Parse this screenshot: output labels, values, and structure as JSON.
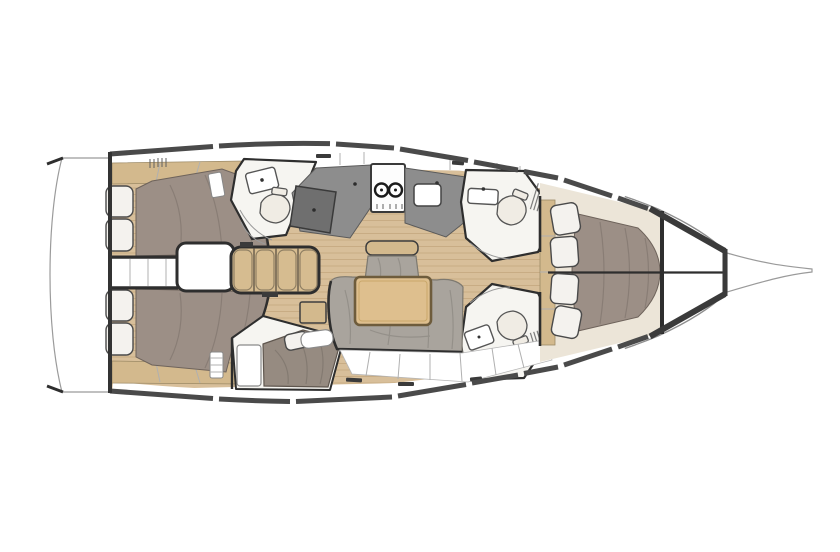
{
  "diagram": {
    "kind": "sailboat-interior-floor-plan",
    "orientation": "bow-right"
  },
  "palette": {
    "white": "#ffffff",
    "hull_outline": "#8e8e8e",
    "wall": "#2e2e2e",
    "deck_band": "#4a4a4a",
    "floor_wood": "#d8bf9a",
    "floor_seam": "#bb9d72",
    "shelf_wood": "#d3b98d",
    "step_wood": "#d6bc90",
    "mattress": "#9c8f86",
    "berth": "#968b81",
    "sofa": "#a9a49d",
    "sofa_edge": "#7d7970",
    "table_wood": "#debf8e",
    "table_edge": "#6e5c3c",
    "counter": "#8d8d8d",
    "desk": "#6f6f6f",
    "fixture": "#f0ece4",
    "pillow": "#f4f2ee",
    "cream": "#ece5d8"
  },
  "features": {
    "aft_cabins": 2,
    "forward_cabins": 1,
    "heads": 3,
    "stove_burners": 2,
    "companionway_steps": 4,
    "aft_cabin_pillows_each": 2,
    "forward_cabin_pillows": 4,
    "salon_table": 1,
    "swim_platform": 1,
    "bowsprit": 1
  }
}
